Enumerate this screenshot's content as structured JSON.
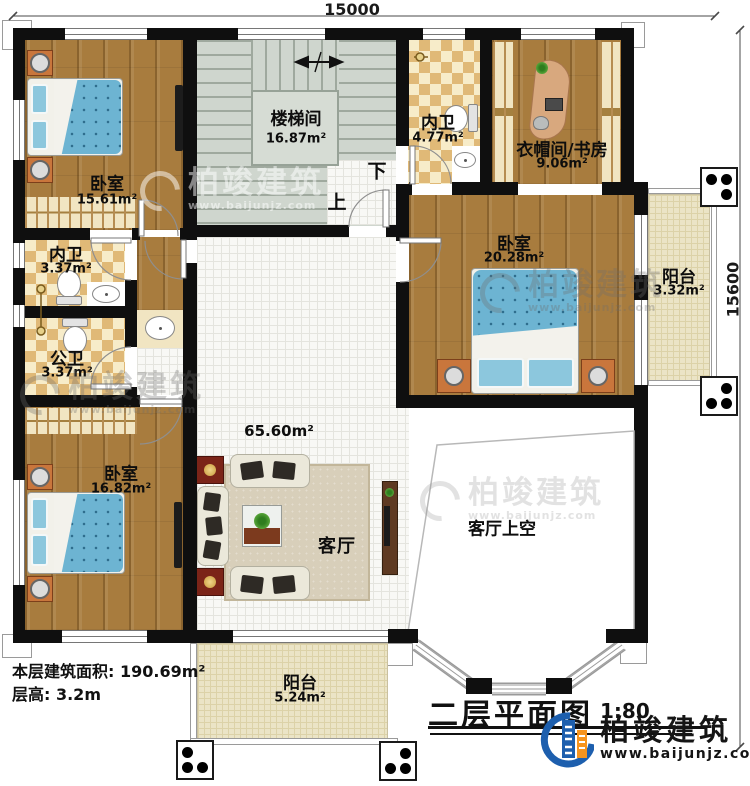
{
  "dims": {
    "top": "15000",
    "right": "15600"
  },
  "rooms": {
    "bedroom_tl": {
      "name": "卧室",
      "area": "15.61m²"
    },
    "stairwell": {
      "name": "楼梯间",
      "area": "16.87m²"
    },
    "bath_top": {
      "name": "内卫",
      "area": "4.77m²"
    },
    "cloak_study": {
      "name": "衣帽间/书房",
      "area": "9.06m²"
    },
    "bedroom_r": {
      "name": "卧室",
      "area": "20.28m²"
    },
    "balcony_r": {
      "name": "阳台",
      "area": "3.32m²"
    },
    "bath_mid": {
      "name": "内卫",
      "area": "3.37m²"
    },
    "bath_public": {
      "name": "公卫",
      "area": "3.37m²"
    },
    "bedroom_bl": {
      "name": "卧室",
      "area": "16.82m²"
    },
    "living": {
      "name": "客厅",
      "area": "65.60m²"
    },
    "living_void": {
      "name": "客厅上空"
    },
    "balcony_b": {
      "name": "阳台",
      "area": "5.24m²"
    }
  },
  "stairs": {
    "up": "上",
    "down": "下"
  },
  "annotations": {
    "floor_area": "本层建筑面积: 190.69m²",
    "floor_height": "层高: 3.2m"
  },
  "title_block": {
    "title": "二层平面图",
    "scale": "1:80"
  },
  "brand": {
    "name": "柏竣建筑",
    "website": "www.baijunjz.com"
  },
  "watermark": {
    "name": "柏竣建筑",
    "website": "www.baijunjz.com"
  },
  "colors": {
    "wall": "#0f0f0f",
    "wood": "#a87c3e",
    "checker_dark": "#e0b977",
    "checker_light": "#f7ecc9",
    "tile": "#f8f8f5",
    "stair": "#cfd6ce",
    "balcony": "#ebe4c6",
    "brand_blue": "#1d5fae",
    "brand_orange": "#f7941d",
    "bed_blue": "#6db4d2"
  }
}
